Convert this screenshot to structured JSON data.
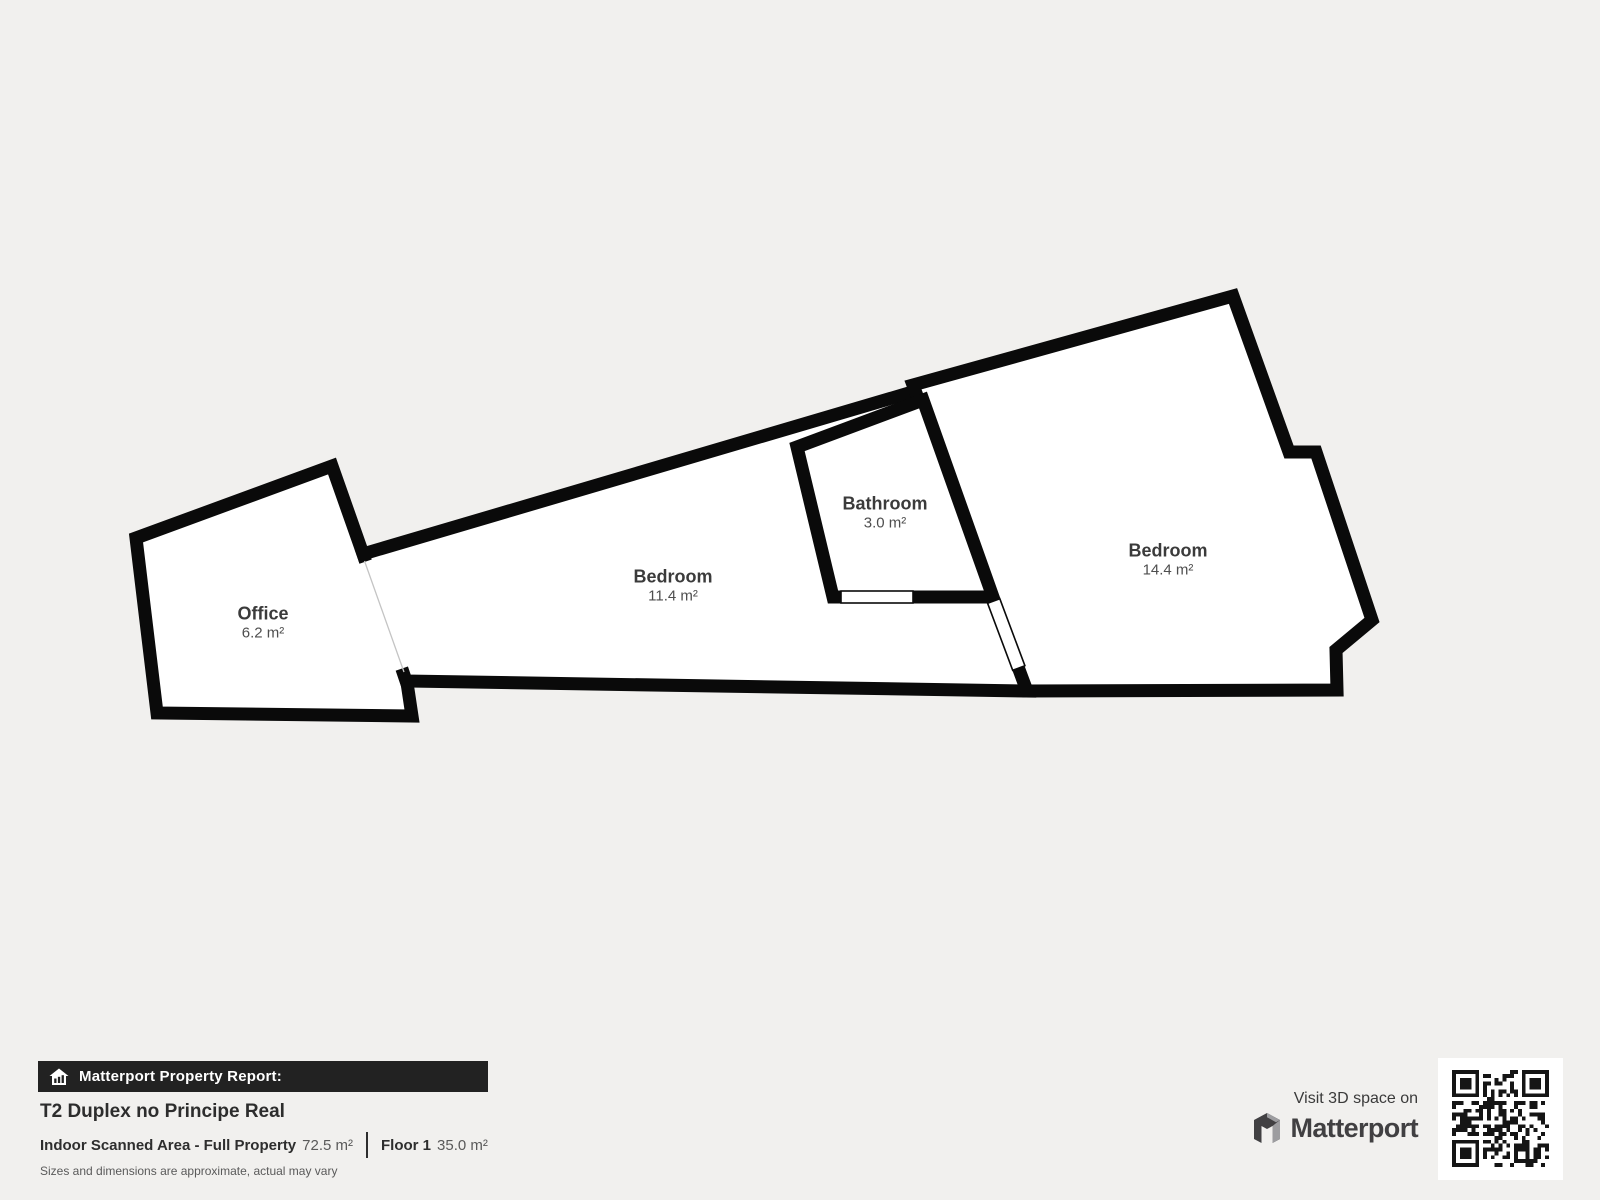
{
  "plan": {
    "rooms": [
      {
        "name": "Office",
        "area": "6.2 m²"
      },
      {
        "name": "Bedroom",
        "area": "11.4 m²"
      },
      {
        "name": "Bathroom",
        "area": "3.0 m²"
      },
      {
        "name": "Bedroom",
        "area": "14.4 m²"
      }
    ]
  },
  "report": {
    "badge": "Matterport Property Report:",
    "title": "T2 Duplex no Principe Real",
    "scanned_label": "Indoor Scanned Area - Full Property",
    "scanned_value": "72.5 m²",
    "floor_label": "Floor 1",
    "floor_value": "35.0 m²",
    "disclaimer": "Sizes and dimensions are approximate, actual may vary"
  },
  "branding": {
    "visit_text": "Visit 3D space on",
    "logo_text": "Matterport"
  },
  "colors": {
    "background": "#f1f0ee",
    "wall": "#0a0a0a",
    "room_fill": "#ffffff",
    "bar_background": "#222222",
    "logo_gray": "#414042",
    "logo_accent": "#9d9da0"
  }
}
